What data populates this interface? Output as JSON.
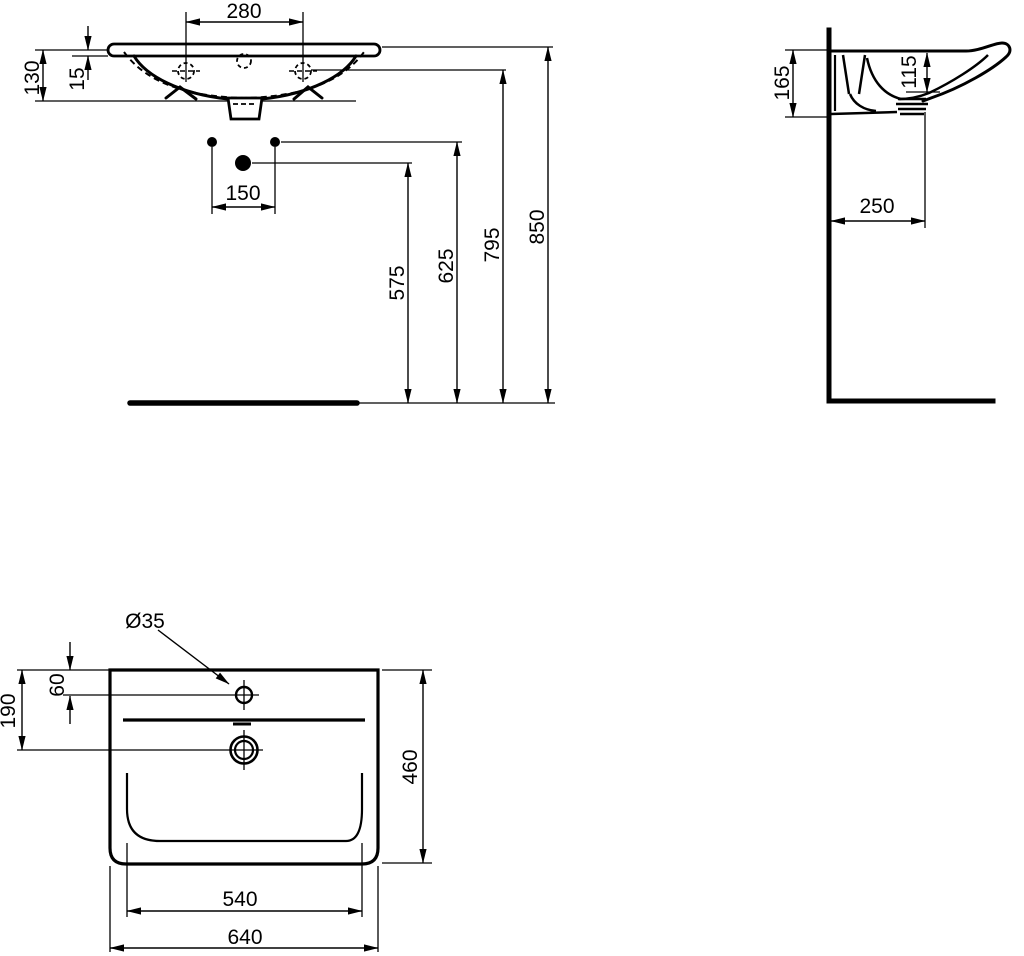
{
  "colors": {
    "line": "#000000",
    "background": "#ffffff"
  },
  "front_view": {
    "labels": {
      "tap_hole_spacing": "280",
      "rim_height": "130",
      "edge_thickness": "15",
      "fixing_hole_spacing": "150",
      "drain_height": "575",
      "fixing_holes_height": "625",
      "tap_holes_height": "795",
      "rim_top_height": "850"
    }
  },
  "side_view": {
    "labels": {
      "depth_at_wall": "165",
      "bowl_inner_depth": "115",
      "drain_wall_distance": "250"
    }
  },
  "plan_view": {
    "labels": {
      "tap_hole_diameter": "Ø35",
      "tap_hole_offset": "60",
      "drain_offset": "190",
      "overall_depth": "460",
      "inner_width": "540",
      "overall_width": "640"
    }
  }
}
